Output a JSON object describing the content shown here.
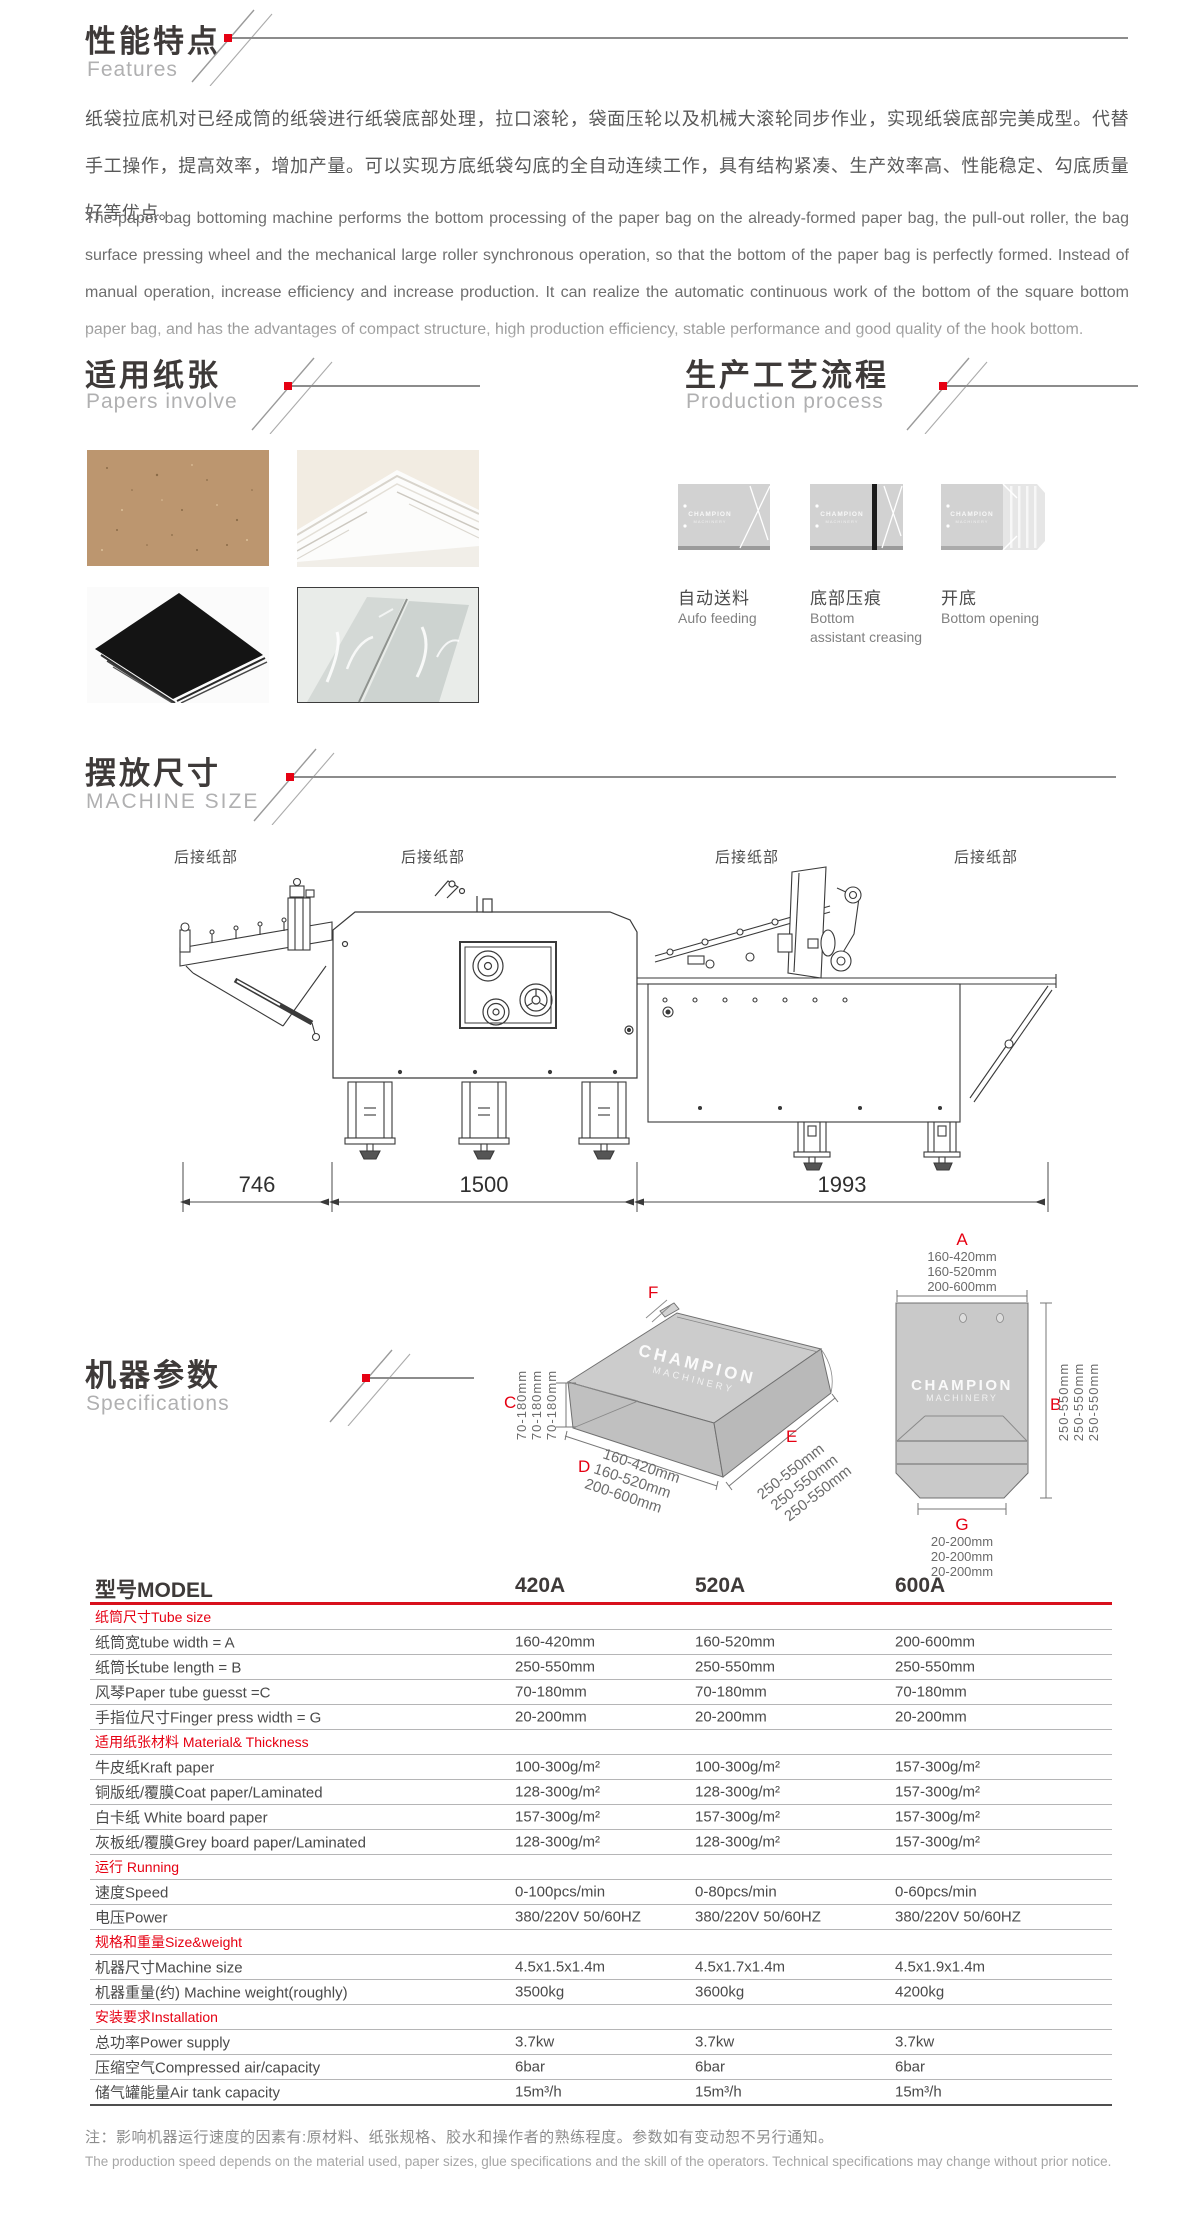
{
  "colors": {
    "accent": "#e60012",
    "title": "#3e3a39",
    "subtitle": "#b0b0b1",
    "rule": "#8c8c8c",
    "table_red_line": "#d8101c",
    "bag_fill": "#c9c9c9"
  },
  "features": {
    "title_cn": "性能特点",
    "title_en": "Features",
    "paragraph_cn": "纸袋拉底机对已经成筒的纸袋进行纸袋底部处理，拉口滚轮，袋面压轮以及机械大滚轮同步作业，实现纸袋底部完美成型。代替手工操作，提高效率，增加产量。可以实现方底纸袋勾底的全自动连续工作，具有结构紧凑、生产效率高、性能稳定、勾底质量好等优点。",
    "paragraph_en": "The paper bag bottoming machine performs the bottom processing of the paper bag on the already-formed paper bag, the pull-out roller, the bag surface pressing wheel and the mechanical large roller synchronous operation, so that the bottom of the paper bag is perfectly formed. Instead of manual operation, increase efficiency and increase production. It can realize the automatic continuous work of the bottom of the square bottom paper bag, and has the advantages of compact structure, high production efficiency, stable performance and good quality of the hook bottom."
  },
  "papers": {
    "title_cn": "适用纸张",
    "title_en": "Papers involve",
    "photos": [
      "kraft-paper",
      "white-paper-stack",
      "black-paper",
      "laminated-glossy-paper"
    ]
  },
  "process": {
    "title_cn": "生产工艺流程",
    "title_en": "Production process",
    "watermark1": "CHAMPION",
    "watermark2": "MACHINERY",
    "steps": [
      {
        "label_cn": "自动送料",
        "label_en1": "Aufo feeding",
        "label_en2": ""
      },
      {
        "label_cn": "底部压痕",
        "label_en1": "Bottom",
        "label_en2": "assistant creasing"
      },
      {
        "label_cn": "开底",
        "label_en1": "Bottom opening",
        "label_en2": ""
      }
    ]
  },
  "machine_size": {
    "title_cn": "摆放尺寸",
    "title_en": "MACHINE SIZE",
    "part_label": "后接纸部",
    "dims": [
      "746",
      "1500",
      "1993"
    ]
  },
  "specifications": {
    "title_cn": "机器参数",
    "title_en": "Specifications",
    "watermark1": "CHAMPION",
    "watermark2": "MACHINERY",
    "bag_dims": {
      "A": {
        "letter": "A",
        "lines": [
          "160-420mm",
          "160-520mm",
          "200-600mm"
        ]
      },
      "B": {
        "letter": "B",
        "lines": [
          "250-550mm",
          "250-550mm",
          "250-550mm"
        ]
      },
      "C": {
        "letter": "C",
        "lines": [
          "70-180mm",
          "70-180mm",
          "70-180mm"
        ]
      },
      "D": {
        "letter": "D",
        "lines": [
          "160-420mm",
          "160-520mm",
          "200-600mm"
        ]
      },
      "E": {
        "letter": "E",
        "lines": [
          "250-550mm",
          "250-550mm",
          "250-550mm"
        ]
      },
      "F": {
        "letter": "F"
      },
      "G": {
        "letter": "G",
        "lines": [
          "20-200mm",
          "20-200mm",
          "20-200mm"
        ]
      }
    }
  },
  "table": {
    "model_label": "型号MODEL",
    "models": [
      "420A",
      "520A",
      "600A"
    ],
    "rows": [
      {
        "type": "section",
        "label": "纸筒尺寸Tube size"
      },
      {
        "type": "data",
        "label": "纸筒宽tube width = A",
        "v": [
          "160-420mm",
          "160-520mm",
          "200-600mm"
        ]
      },
      {
        "type": "data",
        "label": "纸筒长tube length = B",
        "v": [
          "250-550mm",
          "250-550mm",
          "250-550mm"
        ]
      },
      {
        "type": "data",
        "label": "风琴Paper tube guesst =C",
        "v": [
          "70-180mm",
          "70-180mm",
          "70-180mm"
        ]
      },
      {
        "type": "data",
        "label": "手指位尺寸Finger press width = G",
        "v": [
          "20-200mm",
          "20-200mm",
          "20-200mm"
        ]
      },
      {
        "type": "section",
        "label": "适用纸张材料 Material& Thickness"
      },
      {
        "type": "data",
        "label": "牛皮纸Kraft paper",
        "v": [
          "100-300g/m²",
          "100-300g/m²",
          "157-300g/m²"
        ]
      },
      {
        "type": "data",
        "label": "铜版纸/覆膜Coat paper/Laminated",
        "v": [
          "128-300g/m²",
          "128-300g/m²",
          "157-300g/m²"
        ]
      },
      {
        "type": "data",
        "label": "白卡纸 White board paper",
        "v": [
          "157-300g/m²",
          "157-300g/m²",
          "157-300g/m²"
        ]
      },
      {
        "type": "data",
        "label": "灰板纸/覆膜Grey board paper/Laminated",
        "v": [
          "128-300g/m²",
          "128-300g/m²",
          "157-300g/m²"
        ]
      },
      {
        "type": "section",
        "label": "运行 Running"
      },
      {
        "type": "data",
        "label": "速度Speed",
        "v": [
          "0-100pcs/min",
          "0-80pcs/min",
          "0-60pcs/min"
        ]
      },
      {
        "type": "data",
        "label": "电压Power",
        "v": [
          "380/220V 50/60HZ",
          "380/220V 50/60HZ",
          "380/220V 50/60HZ"
        ]
      },
      {
        "type": "section",
        "label": "规格和重量Size&weight"
      },
      {
        "type": "data",
        "label": "机器尺寸Machine size",
        "v": [
          "4.5x1.5x1.4m",
          "4.5x1.7x1.4m",
          "4.5x1.9x1.4m"
        ]
      },
      {
        "type": "data",
        "label": "机器重量(约) Machine weight(roughly)",
        "v": [
          "3500kg",
          "3600kg",
          "4200kg"
        ]
      },
      {
        "type": "section",
        "label": "安装要求Installation"
      },
      {
        "type": "data",
        "label": "总功率Power supply",
        "v": [
          "3.7kw",
          "3.7kw",
          "3.7kw"
        ]
      },
      {
        "type": "data",
        "label": "压缩空气Compressed air/capacity",
        "v": [
          "6bar",
          "6bar",
          "6bar"
        ]
      },
      {
        "type": "data",
        "label": "储气罐能量Air tank capacity",
        "v": [
          "15m³/h",
          "15m³/h",
          "15m³/h"
        ]
      }
    ]
  },
  "notes": {
    "cn": "注：影响机器运行速度的因素有:原材料、纸张规格、胶水和操作者的熟练程度。参数如有变动恕不另行通知。",
    "en": "The production speed depends on the material used, paper sizes, glue specifications and the skill of the operators. Technical specifications may change without prior notice."
  }
}
